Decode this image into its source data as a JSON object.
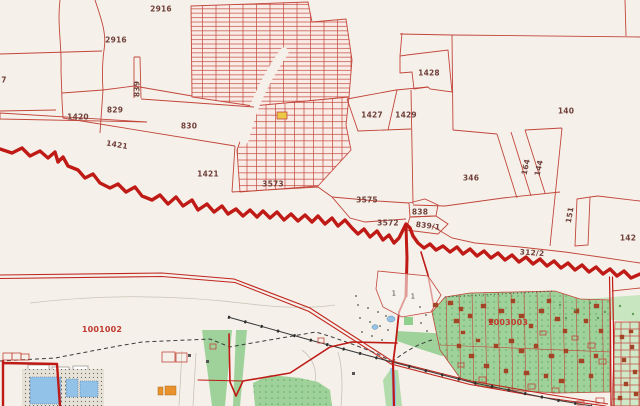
{
  "map": {
    "title": "Cadastral map view",
    "background": "#f5f1ea",
    "colors": {
      "parcel_line": "#c2453a",
      "thick_boundary": "#bf1a15",
      "grid_fill": "#f9ece7",
      "parcel_label": "#70403a",
      "quarter_label": "#c03a2e",
      "garden_green": "#9ed29a",
      "pale_green": "#c8e6c0",
      "water_blue": "#93c2e8",
      "building_orange": "#e8912d",
      "building_brown": "#9e4726",
      "railway_black": "#3a3a3a",
      "highlight_yellow": "#ecc944"
    },
    "labels": [
      {
        "text": "2916",
        "x": 161,
        "y": 9
      },
      {
        "text": "2916",
        "x": 116,
        "y": 40
      },
      {
        "text": "7",
        "x": 4,
        "y": 80
      },
      {
        "text": "1420",
        "x": 78,
        "y": 117
      },
      {
        "text": "829",
        "x": 115,
        "y": 110
      },
      {
        "text": "839",
        "x": 137,
        "y": 89,
        "rot": -90
      },
      {
        "text": "830",
        "x": 189,
        "y": 126
      },
      {
        "text": "1421",
        "x": 117,
        "y": 145,
        "rot": 10
      },
      {
        "text": "1421",
        "x": 208,
        "y": 174
      },
      {
        "text": "1428",
        "x": 429,
        "y": 73
      },
      {
        "text": "1427",
        "x": 372,
        "y": 115
      },
      {
        "text": "1429",
        "x": 406,
        "y": 115
      },
      {
        "text": "140",
        "x": 566,
        "y": 111
      },
      {
        "text": "3573",
        "x": 273,
        "y": 184
      },
      {
        "text": "3575",
        "x": 367,
        "y": 200
      },
      {
        "text": "346",
        "x": 471,
        "y": 178
      },
      {
        "text": "164",
        "x": 526,
        "y": 167,
        "rot": -78
      },
      {
        "text": "144",
        "x": 539,
        "y": 168,
        "rot": -78
      },
      {
        "text": "151",
        "x": 570,
        "y": 215,
        "rot": -80
      },
      {
        "text": "142",
        "x": 628,
        "y": 238
      },
      {
        "text": "3572",
        "x": 388,
        "y": 223
      },
      {
        "text": "838",
        "x": 420,
        "y": 212
      },
      {
        "text": "839/1",
        "x": 428,
        "y": 226,
        "rot": 7
      },
      {
        "text": "312/2",
        "x": 532,
        "y": 253,
        "rot": 4
      },
      {
        "text": "1001002",
        "x": 102,
        "y": 330,
        "cls": "quarter"
      },
      {
        "text": "1003003",
        "x": 508,
        "y": 323,
        "cls": "quarter"
      },
      {
        "text": "1",
        "x": 394,
        "y": 294,
        "cls": "small"
      },
      {
        "text": "1",
        "x": 413,
        "y": 297,
        "cls": "small"
      }
    ]
  }
}
